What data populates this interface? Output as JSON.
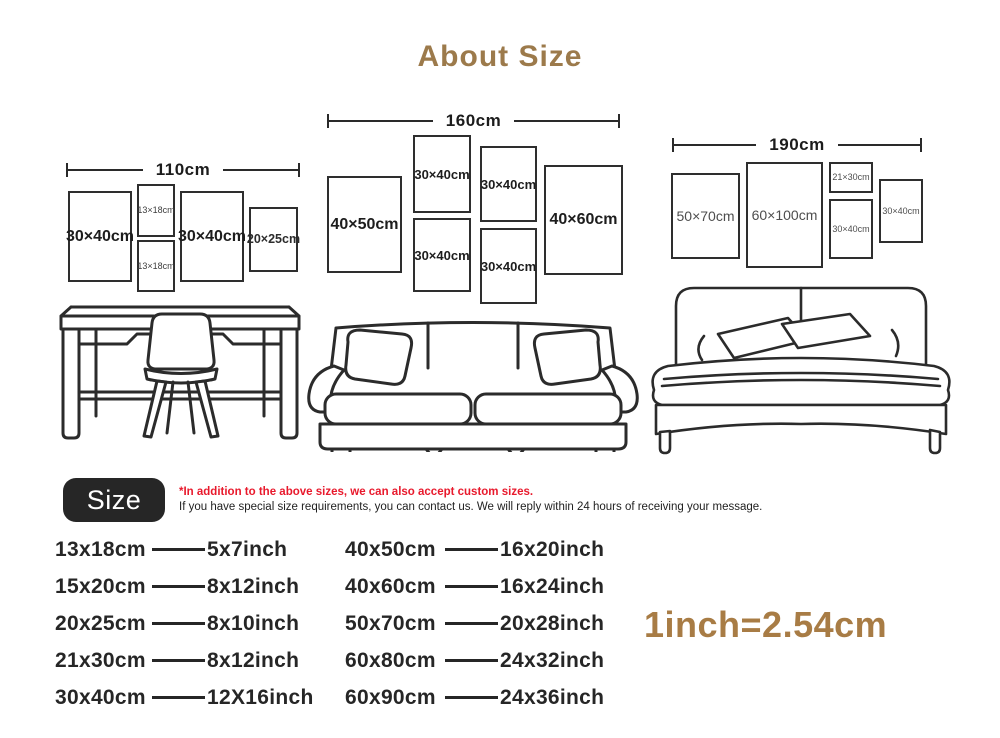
{
  "title": "About Size",
  "colors": {
    "accent_brown": "#9c7a4b",
    "conversion_brown": "#a87c45",
    "note_red": "#e8192c",
    "badge_bg": "#262626",
    "line_dark": "#2a2a2a"
  },
  "walls": [
    {
      "width_label": "110cm",
      "frames": [
        {
          "label": "30×40cm"
        },
        {
          "label": "13×18cm"
        },
        {
          "label": "13×18cm"
        },
        {
          "label": "30×40cm"
        },
        {
          "label": "20×25cm"
        }
      ]
    },
    {
      "width_label": "160cm",
      "frames": [
        {
          "label": "40×50cm"
        },
        {
          "label": "30×40cm"
        },
        {
          "label": "30×40cm"
        },
        {
          "label": "30×40cm"
        },
        {
          "label": "30×40cm"
        },
        {
          "label": "40×60cm"
        }
      ]
    },
    {
      "width_label": "190cm",
      "frames": [
        {
          "label": "50×70cm"
        },
        {
          "label": "60×100cm"
        },
        {
          "label": "21×30cm"
        },
        {
          "label": "30×40cm"
        },
        {
          "label": "30×40cm"
        }
      ]
    }
  ],
  "furniture_icons": [
    "desk-with-chair",
    "sofa",
    "double-bed"
  ],
  "size_section": {
    "badge_label": "Size",
    "note_red": "*In addition to the above sizes, we can also accept custom sizes.",
    "note_black": "If you have special size requirements, you can contact us. We will reply within 24 hours of receiving your message."
  },
  "size_table": {
    "column1": [
      {
        "cm": "13x18cm",
        "inch": "5x7inch"
      },
      {
        "cm": "15x20cm",
        "inch": "8x12inch"
      },
      {
        "cm": "20x25cm",
        "inch": "8x10inch"
      },
      {
        "cm": "21x30cm",
        "inch": "8x12inch"
      },
      {
        "cm": "30x40cm",
        "inch": "12X16inch"
      }
    ],
    "column2": [
      {
        "cm": "40x50cm",
        "inch": "16x20inch"
      },
      {
        "cm": "40x60cm",
        "inch": "16x24inch"
      },
      {
        "cm": "50x70cm",
        "inch": "20x28inch"
      },
      {
        "cm": "60x80cm",
        "inch": "24x32inch"
      },
      {
        "cm": "60x90cm",
        "inch": "24x36inch"
      }
    ]
  },
  "conversion_note": "1inch=2.54cm"
}
